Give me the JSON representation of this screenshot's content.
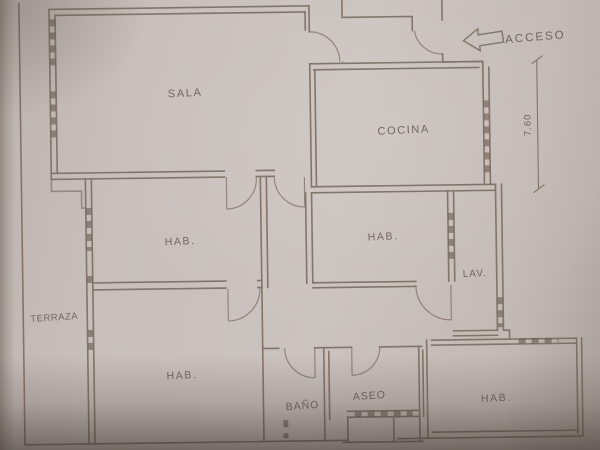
{
  "document": {
    "kind": "apartment floor plan (scanned pencil drawing)"
  },
  "colors": {
    "paper": "#c8bfbb",
    "ink": "#7d6e64",
    "label_text": "#675850",
    "shadow": "#564840"
  },
  "rooms": {
    "sala": {
      "label": "SALA"
    },
    "cocina": {
      "label": "COCINA"
    },
    "hab_mid_left": {
      "label": "HAB."
    },
    "hab_mid_center": {
      "label": "HAB."
    },
    "lav": {
      "label": "LAV."
    },
    "terraza": {
      "label": "TERRAZA"
    },
    "hab_bottom_left": {
      "label": "HAB."
    },
    "bano": {
      "label": "BAÑO"
    },
    "aseo": {
      "label": "ASEO"
    },
    "hab_bottom_right": {
      "label": "HAB."
    }
  },
  "annotations": {
    "acceso": {
      "label": "ACCESO",
      "arrow_direction": "left"
    },
    "dimension_right": {
      "value": "7.60",
      "orientation": "vertical"
    }
  }
}
